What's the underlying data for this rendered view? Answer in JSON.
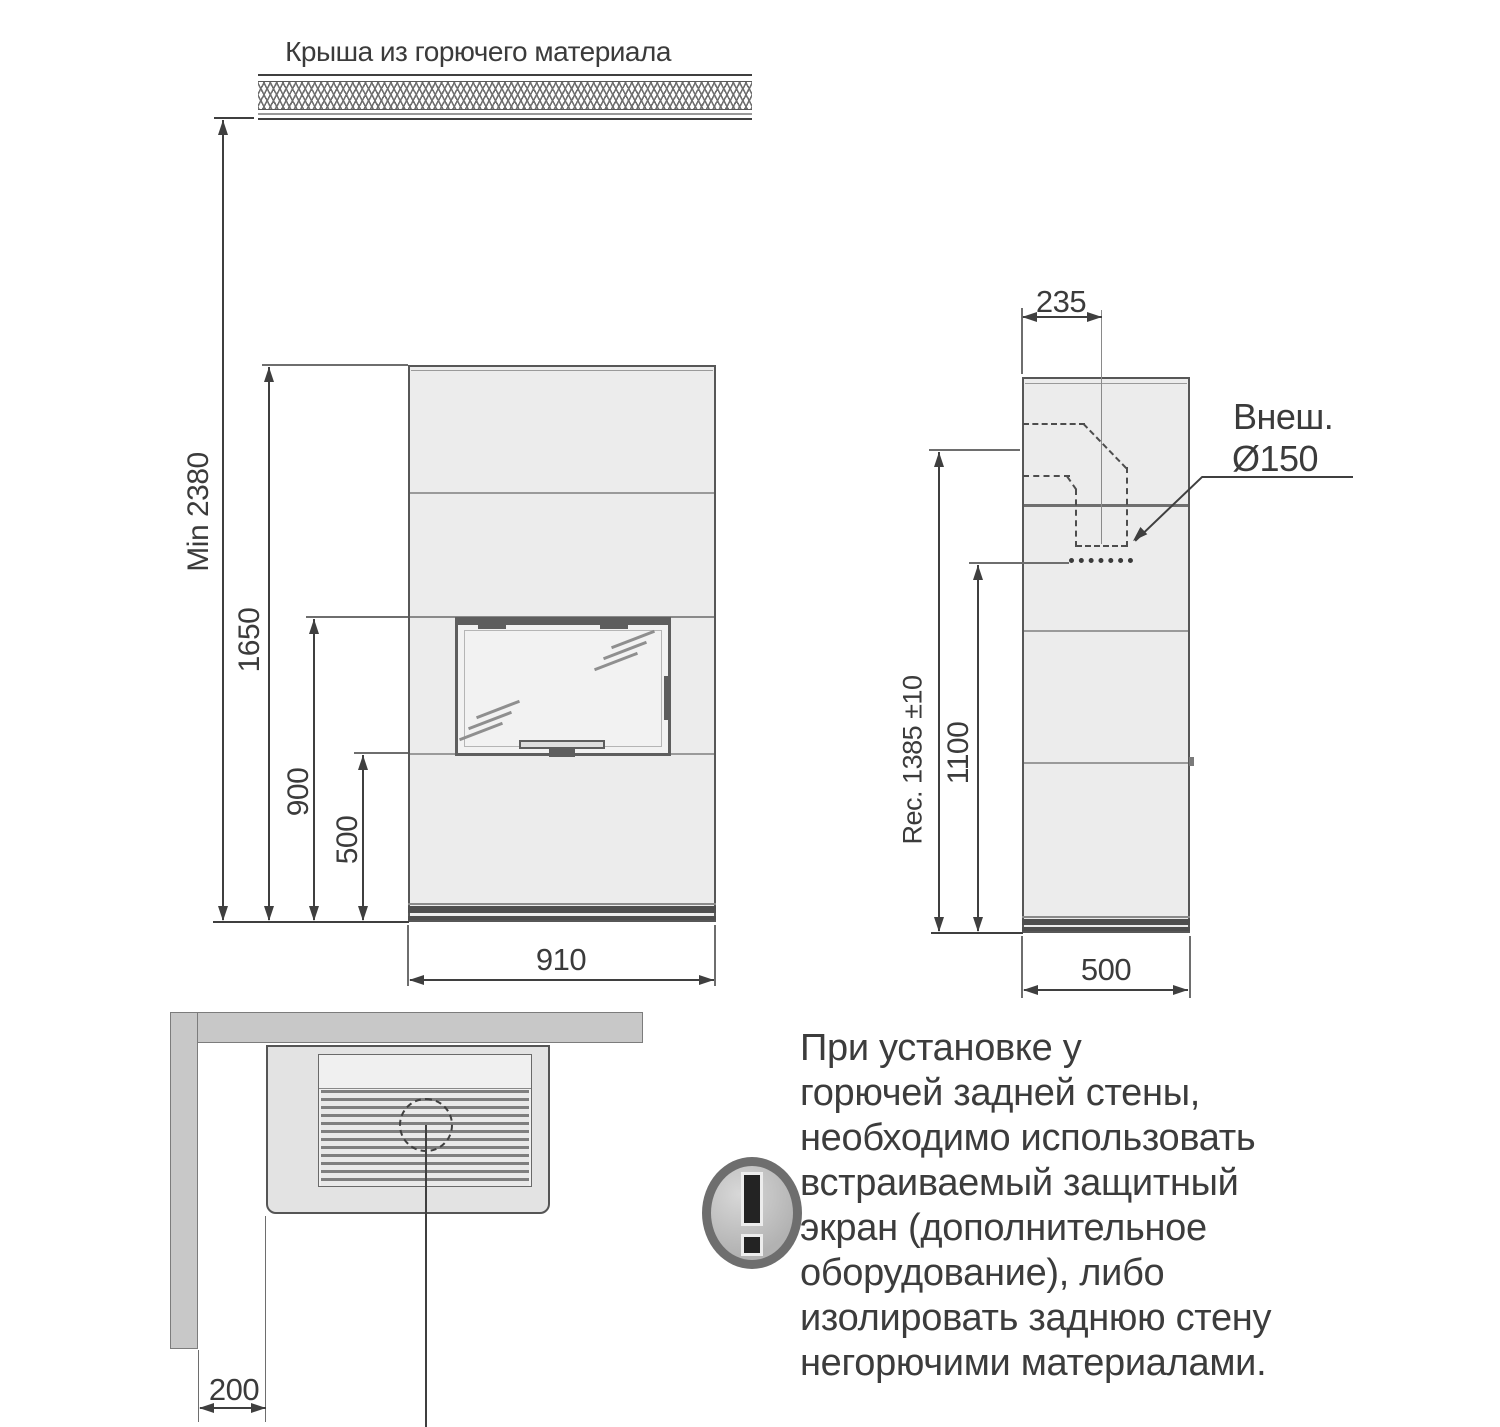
{
  "roof": {
    "label": "Крыша из горючего материала"
  },
  "front_view": {
    "dim_total_height": "Min 2380",
    "dim_stove_height": "1650",
    "dim_door_top": "900",
    "dim_door_bottom": "500",
    "dim_width": "910"
  },
  "side_view": {
    "dim_flue_center_offset": "235",
    "dim_recommended_height": "Rec. 1385 ±10",
    "dim_rear_outlet_height": "1100",
    "dim_depth": "500",
    "flue_label_line1": "Внеш.",
    "flue_label_line2": "Ø150"
  },
  "top_view": {
    "dim_wall_clearance": "200"
  },
  "warning": {
    "icon": "exclamation-icon",
    "text": "При установке у\nгорючей задней стены,\nнеобходимо использовать\nвстраиваемый защитный\nэкран (дополнительное\nоборудование), либо\nизолировать заднюю стену\nнегорючими материалами."
  },
  "colors": {
    "line": "#3f3f3f",
    "stove_fill": "#ececec",
    "wall_fill": "#c8c8c8",
    "warning_ring": "#6e6e6e"
  }
}
